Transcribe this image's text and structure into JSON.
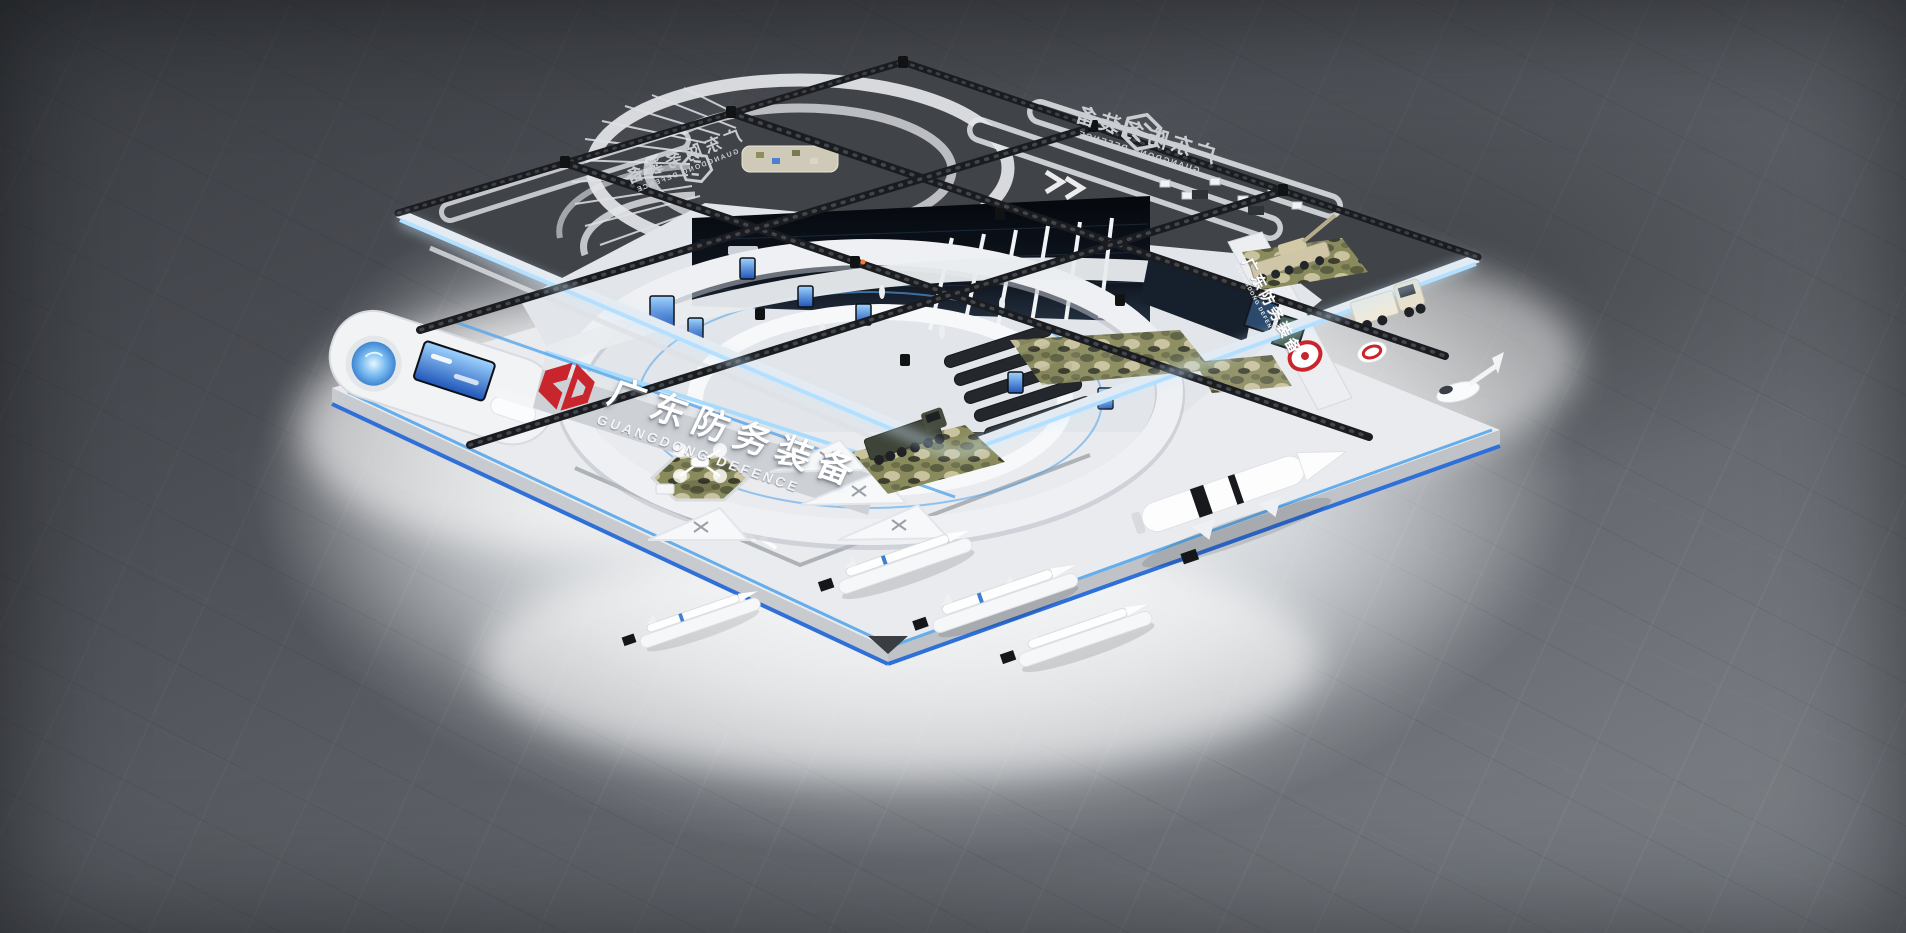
{
  "signs": {
    "main": {
      "zh": "广东防务装备",
      "en": "GUANGDONG DEFENCE"
    },
    "roof_left": {
      "zh": "广东防务装备",
      "en": "GUANGDONG DEFENCE"
    },
    "roof_right": {
      "zh": "广东防务装备",
      "en": "GUANGDONG DEFENCE"
    },
    "side_wall": {
      "zh": "广东防务装备",
      "en": "GUANGDONG DEFENCE"
    }
  },
  "logos": {
    "brand": "gd-monogram-red",
    "roof": "gd-hexagon-outline",
    "wall_ring": "gd-ring-red"
  },
  "colors": {
    "brand_red": "#c8252c",
    "led_bright": "#a8dcff",
    "led_blue": "#57a7ec",
    "trim_blue": "#2f6fd8",
    "roof_dark": "#404449",
    "roof_mark": "#e4e6e9",
    "platform": "#e9ebee",
    "platform_side": "#c7cacf",
    "interior": "#e2e5e9",
    "wall_white": "#f3f5f7",
    "screen_dark": "#0c1118",
    "screen_blue": "#2e6fd4",
    "camo_olive": "#8a8b5d",
    "camo_dark": "#5b5d41",
    "camo_tan": "#c9c29e",
    "truss_dark": "#1a1c20",
    "floor_top": "#3a3d42",
    "floor_bottom": "#75797f",
    "vehicle_tan": "#cfc6a8",
    "vehicle_olive": "#3f4438"
  }
}
